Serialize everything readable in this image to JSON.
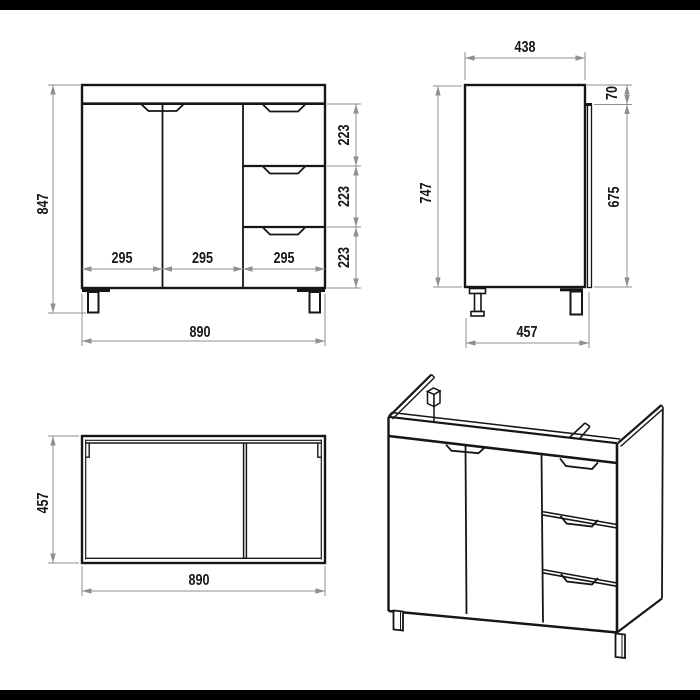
{
  "colors": {
    "background": "#ffffff",
    "drawing_line": "#161616",
    "dimension_line": "#8f8f8f",
    "letterbox_bar": "#000000"
  },
  "front_view": {
    "height": "847",
    "width": "890",
    "section_widths": [
      "295",
      "295",
      "295"
    ],
    "drawer_heights": [
      "223",
      "223",
      "223"
    ]
  },
  "side_view": {
    "top_depth": "438",
    "height": "747",
    "top_gap": "70",
    "door_height": "675",
    "bottom_depth": "457"
  },
  "top_view": {
    "depth": "457",
    "width": "890"
  }
}
